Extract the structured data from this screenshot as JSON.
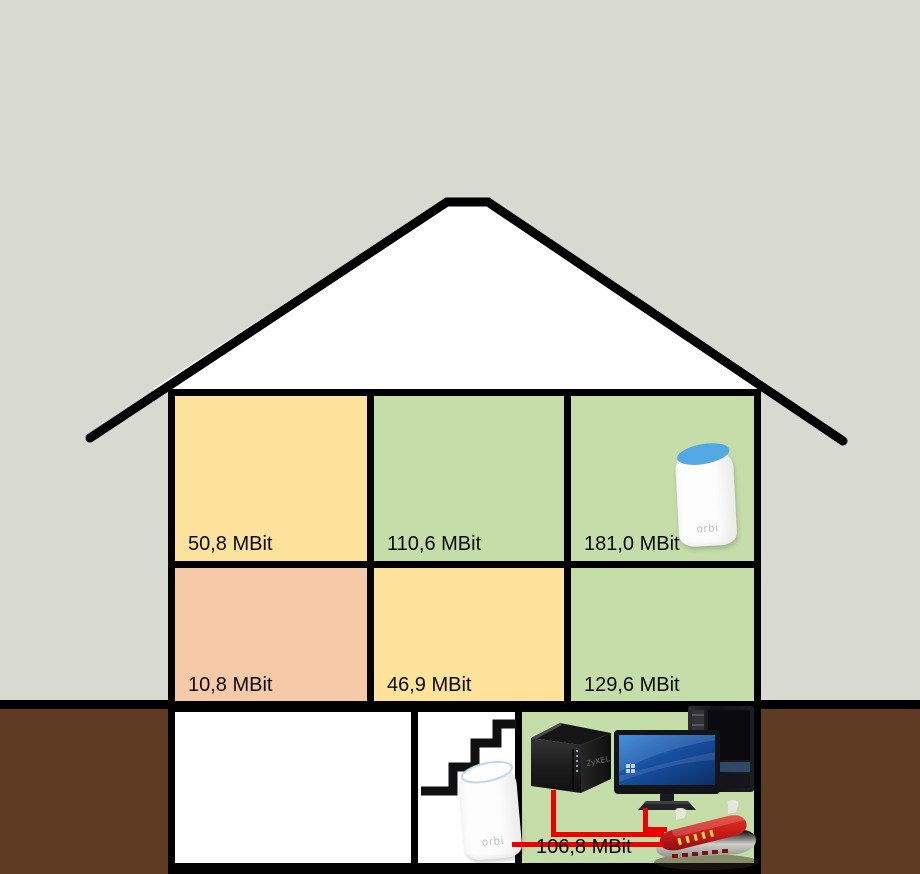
{
  "diagram_title": "house-wifi-speed-cross-section",
  "background": {
    "sky_color": "#d8dad1",
    "ground_color": "#5e3b23",
    "wall_color": "#000000"
  },
  "house": {
    "upper_floor": [
      {
        "id": "upper-left",
        "speed_label": "50,8 MBit",
        "fill": "#fce29a"
      },
      {
        "id": "upper-middle",
        "speed_label": "110,6 MBit",
        "fill": "#c4dda9"
      },
      {
        "id": "upper-right",
        "speed_label": "181,0 MBit",
        "fill": "#c4dda9",
        "device": "orbi-satellite"
      }
    ],
    "middle_floor": [
      {
        "id": "middle-left",
        "speed_label": "10,8 MBit",
        "fill": "#f6caa9"
      },
      {
        "id": "middle-middle",
        "speed_label": "46,9 MBit",
        "fill": "#fce29a"
      },
      {
        "id": "middle-right",
        "speed_label": "129,6 MBit",
        "fill": "#c4dda9"
      }
    ],
    "basement": {
      "link_speed_label": "106,8 MBit",
      "link_color": "#ee0000",
      "devices": [
        "stairs",
        "orbi-router",
        "zyxel-nas",
        "desktop-computer",
        "fritzbox-router"
      ]
    }
  },
  "device_labels": {
    "orbi": "orbi",
    "nas_brand": "ZyXEL"
  }
}
